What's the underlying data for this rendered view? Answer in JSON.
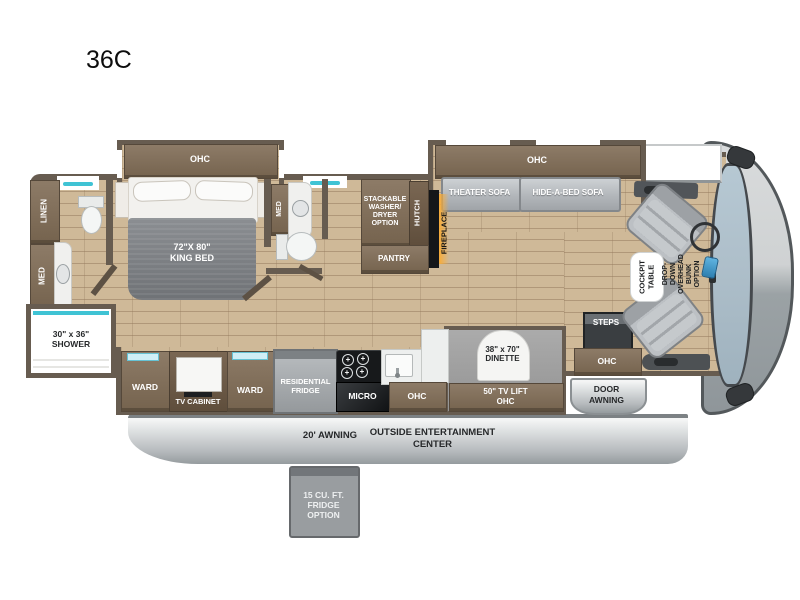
{
  "title": "36C",
  "colors": {
    "wall": "#675c50",
    "floor": "#cfb998",
    "cabinet": "#7d6c59",
    "teal_accent": "#3fc3d4",
    "sofa_gray": "#b5b9bd",
    "awning_gray": "#c9cdd0",
    "fireplace_glow": "#f7a93d",
    "windshield_blue": "#aabfcc"
  },
  "icons": {
    "burner": "+"
  },
  "labels": {
    "ohc_bed": "OHC",
    "linen": "LINEN",
    "med_rear": "MED",
    "shower": "30\" x 36\"\nSHOWER",
    "king_bed": "72\"X 80\"\nKING BED",
    "med_mid": "MED",
    "washer_dryer": "STACKABLE\nWASHER/\nDRYER\nOPTION",
    "hutch": "HUTCH",
    "pantry": "PANTRY",
    "fireplace": "FIREPLACE",
    "ohc_sofa": "OHC",
    "theater_sofa": "THEATER SOFA",
    "hide_a_bed_sofa": "HIDE-A-BED SOFA",
    "cockpit_table": "COCKPIT\nTABLE",
    "drop_down_bunk": "DROP-DOWN\nOVERHEAD BUNK\nOPTION",
    "steps": "STEPS",
    "ohc_entry": "OHC",
    "door_awning": "DOOR\nAWNING",
    "ward_left": "WARD",
    "tv_cabinet": "TV CABINET",
    "ward_right": "WARD",
    "residential_fridge": "RESIDENTIAL\nFRIDGE",
    "micro": "MICRO",
    "ohc_kitchen": "OHC",
    "dinette": "38\" x 70\"\nDINETTE",
    "tv_lift_ohc": "50\" TV LIFT\nOHC",
    "awning_20": "20' AWNING",
    "outside_entertainment": "OUTSIDE ENTERTAINMENT\nCENTER",
    "fridge_option": "15 CU. FT.\nFRIDGE\nOPTION"
  }
}
